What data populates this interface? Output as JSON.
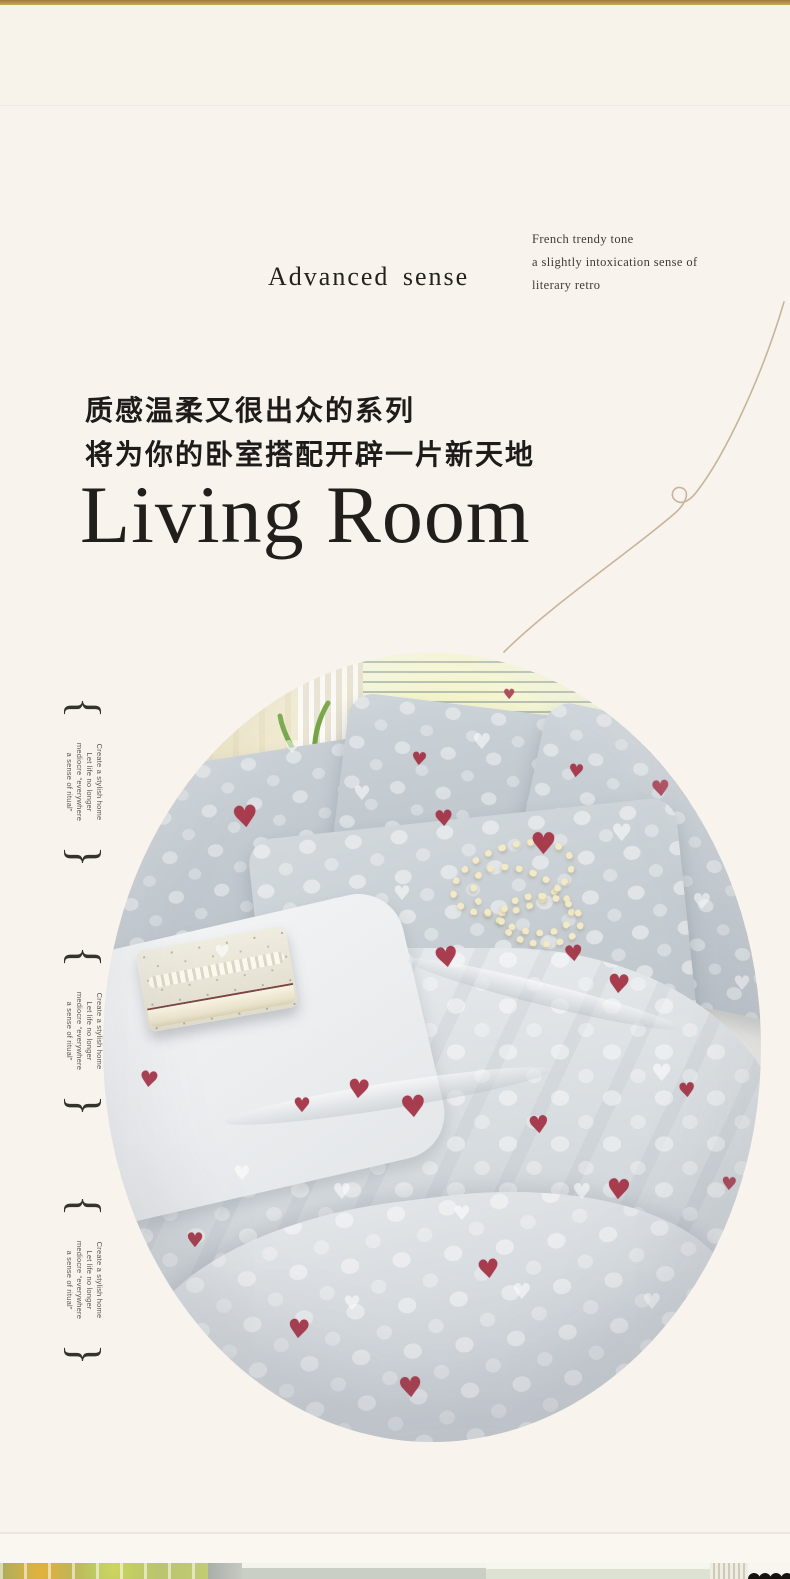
{
  "header": {
    "brand": "Advanced sense",
    "tagline": [
      "French trendy tone",
      "a slightly intoxication sense of",
      "literary retro"
    ]
  },
  "intro": {
    "cn_line1": "质感温柔又很出众的系列",
    "cn_line2": "将为你的卧室搭配开辟一片新天地",
    "title_en": "Living Room"
  },
  "side_note": {
    "open_brace": "{",
    "close_brace": "}",
    "lines": [
      "Create a stylish home",
      "Let life no longer",
      "mediocre “everywhere",
      "a sense of ritual”"
    ]
  },
  "hero": {
    "heart_glyph": "♥",
    "red_hearts": [
      [
        144,
        165,
        30,
        -6
      ],
      [
        55,
        142,
        16,
        5
      ],
      [
        342,
        167,
        22,
        -4
      ],
      [
        442,
        192,
        30,
        0
      ],
      [
        474,
        119,
        18,
        6
      ],
      [
        559,
        137,
        22,
        -5
      ],
      [
        609,
        92,
        16,
        0
      ],
      [
        407,
        42,
        14,
        0
      ],
      [
        317,
        107,
        18,
        5
      ],
      [
        472,
        302,
        22,
        -6
      ],
      [
        517,
        332,
        26,
        4
      ],
      [
        345,
        305,
        28,
        -8
      ],
      [
        257,
        437,
        26,
        5
      ],
      [
        312,
        455,
        30,
        -4
      ],
      [
        200,
        452,
        20,
        0
      ],
      [
        47,
        428,
        22,
        6
      ],
      [
        437,
        472,
        24,
        -5
      ],
      [
        517,
        537,
        28,
        4
      ],
      [
        387,
        617,
        26,
        -6
      ],
      [
        197,
        677,
        26,
        5
      ],
      [
        309,
        735,
        28,
        -4
      ],
      [
        93,
        587,
        20,
        0
      ],
      [
        585,
        437,
        20,
        -5
      ],
      [
        627,
        532,
        18,
        4
      ]
    ],
    "white_hearts": [
      [
        80,
        120,
        22
      ],
      [
        190,
        95,
        18
      ],
      [
        260,
        140,
        20
      ],
      [
        380,
        90,
        22
      ],
      [
        520,
        180,
        24
      ],
      [
        600,
        250,
        22
      ],
      [
        640,
        330,
        20
      ],
      [
        560,
        420,
        24
      ],
      [
        480,
        540,
        22
      ],
      [
        360,
        560,
        20
      ],
      [
        240,
        540,
        22
      ],
      [
        140,
        520,
        20
      ],
      [
        420,
        640,
        22
      ],
      [
        250,
        650,
        20
      ],
      [
        550,
        650,
        22
      ],
      [
        120,
        300,
        18
      ],
      [
        300,
        240,
        20
      ],
      [
        620,
        180,
        18
      ]
    ]
  },
  "colors": {
    "accent_gold": "#b8944e",
    "background_cream": "#f8f4ed",
    "heart_red": "#a43446",
    "text_dark": "#262320",
    "thread_tan": "#c7b49c"
  }
}
